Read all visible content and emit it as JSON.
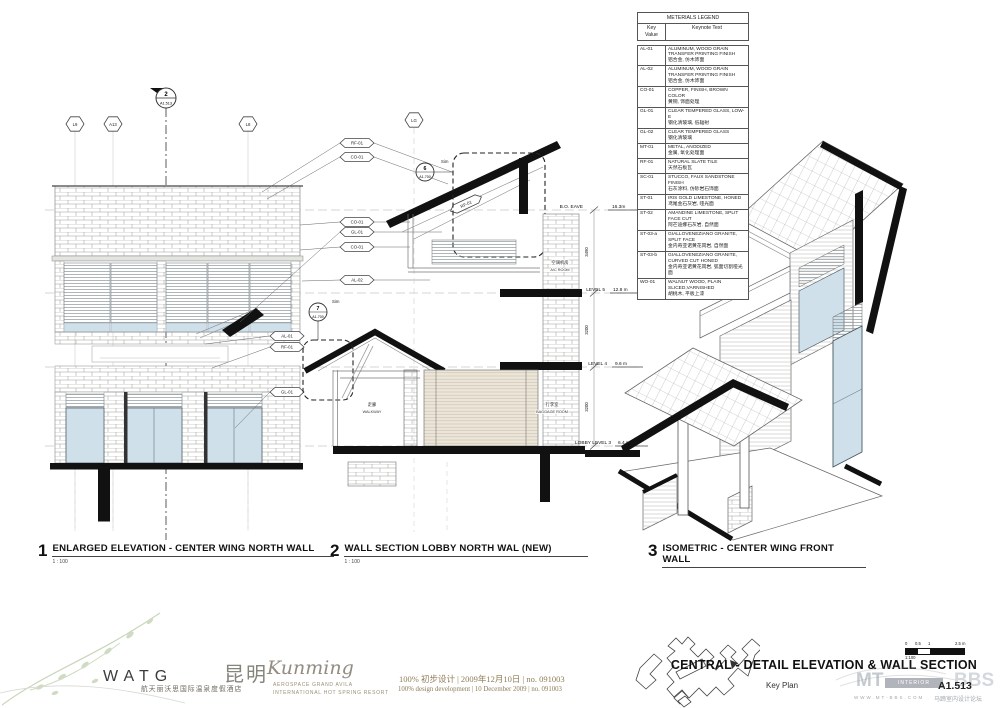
{
  "sheet": {
    "title": "CENTRAL - DETAIL ELEVATION & WALL SECTION",
    "number": "A1.513",
    "key_plan_label": "Key Plan",
    "scale_bar": {
      "ticks": [
        "0",
        "0.5",
        "1",
        "2.5 m"
      ],
      "ratio": "1:100"
    }
  },
  "legend": {
    "title": "METERIALS LEGEND",
    "columns": [
      "Key Value",
      "Keynote Text"
    ],
    "rows": [
      {
        "key": "AL-01",
        "en": "ALUMINUM, WOOD GRAIN TRANSFER PRINTING FINISH",
        "cn": "铝合金, 仿木饰面"
      },
      {
        "key": "AL-02",
        "en": "ALUMINUM, WOOD GRAIN TRANSFER PRINTING FINISH",
        "cn": "铝合金, 仿木饰面"
      },
      {
        "key": "CO-01",
        "en": "COPPER, FINISH, BROWN COLOR",
        "cn": "黄铜, 饰面处理"
      },
      {
        "key": "GL-01",
        "en": "CLEAR TEMPERED GLASS, LOW-E",
        "cn": "钢化清玻璃, 低辐射"
      },
      {
        "key": "GL-02",
        "en": "CLEAR TEMPERED GLASS",
        "cn": "钢化清玻璃"
      },
      {
        "key": "MT-01",
        "en": "METAL, ANODIZED",
        "cn": "金属, 氧化处理面"
      },
      {
        "key": "RF-01",
        "en": "NATURAL SLATE TILE",
        "cn": "天然石板瓦"
      },
      {
        "key": "SC-01",
        "en": "STUCCO, FAUX SANDSTONE FINISH",
        "cn": "石灰涂料, 仿砂岩石饰面"
      },
      {
        "key": "ST-01",
        "en": "IRIS GOLD LIMESTONE, HONED",
        "cn": "鸢尾金石灰岩, 哑光面"
      },
      {
        "key": "ST-02",
        "en": "AMANDINE LIMESTONE, SPLIT FACE CUT",
        "cn": "阿芒迪娜石灰岩, 自然面"
      },
      {
        "key": "ST-03-a",
        "en": "GIALLOVENEZIANO GRANITE, SPLIT FACE",
        "cn": "金内奇亚诺黄花岗岩, 自然面"
      },
      {
        "key": "ST-03-b",
        "en": "GIALLOVENEZIANO GRANITE, CURVED CUT HONED",
        "cn": "金内奇亚诺黄花岗岩, 弧面切割哑光面"
      },
      {
        "key": "WO-01",
        "en": "WALNUT WOOD, PLAIN SLICED,VARNISHED",
        "cn": "胡桃木, 平板上漆"
      }
    ]
  },
  "drawing1": {
    "number": "1",
    "title": "ENLARGED ELEVATION - CENTER WING NORTH WALL",
    "scale": "1 : 100",
    "grid_bubbles": [
      "L9",
      "A13",
      "L8"
    ],
    "section_marker": {
      "number": "2",
      "sheet": "A1.513"
    },
    "keynotes_right": [
      "RF-01",
      "CO-01",
      "CO-01",
      "GL-01",
      "CO-01",
      "AL-02"
    ],
    "keynotes_left": [
      "AL-01",
      "RF-01",
      "GL-01"
    ]
  },
  "drawing2": {
    "number": "2",
    "title": "WALL SECTION LOBBY NORTH WAL (NEW)",
    "scale": "1 : 100",
    "grid_bubbles": [
      "LG"
    ],
    "slope_tag": "RF-01",
    "details": [
      {
        "number": "6",
        "sheet": "A1.700",
        "sim": "Sim"
      },
      {
        "number": "7",
        "sheet": "A1.700",
        "sim": "Sim"
      }
    ],
    "levels": [
      {
        "name": "B.O. EAVE",
        "elevation": "16.3m"
      },
      {
        "name": "LEVEL 5",
        "elevation": "12.8 m"
      },
      {
        "name": "LEVEL 4",
        "elevation": "9.6 m"
      },
      {
        "name": "LOBBY LEVEL 3",
        "elevation": "6.4 m"
      }
    ],
    "dimensions": [
      "3490",
      "3200",
      "3200"
    ],
    "rooms": [
      {
        "cn": "空调机房",
        "en": "A/C ROOM"
      },
      {
        "cn": "走廊",
        "en": "WALKWAY"
      },
      {
        "cn": "行李室",
        "en": "BAGGAGE ROOM"
      }
    ]
  },
  "drawing3": {
    "number": "3",
    "title": "ISOMETRIC - CENTER WING FRONT WALL"
  },
  "footer": {
    "logo": "WATG",
    "hotel_cn": "航天丽沃思国际温泉度假酒店",
    "city_cn": "昆明",
    "city_en": "Kunming",
    "resort_line1": "AEROSPACE GRAND AVILA",
    "resort_line2": "INTERNATIONAL HOT SPRING RESORT",
    "phase_cn": "100%  初步设计  |  2009年12月10日  |  no.  091003",
    "phase_en": "100% design development  |  10 December 2009  |  no. 091003"
  },
  "watermark": {
    "mt": "MT",
    "badge": "INTERIOR DESIGN",
    "bbs": "BBS",
    "url": "WWW.MT-BBS.COM",
    "forum_cn": "马蹄室内设计论坛"
  }
}
